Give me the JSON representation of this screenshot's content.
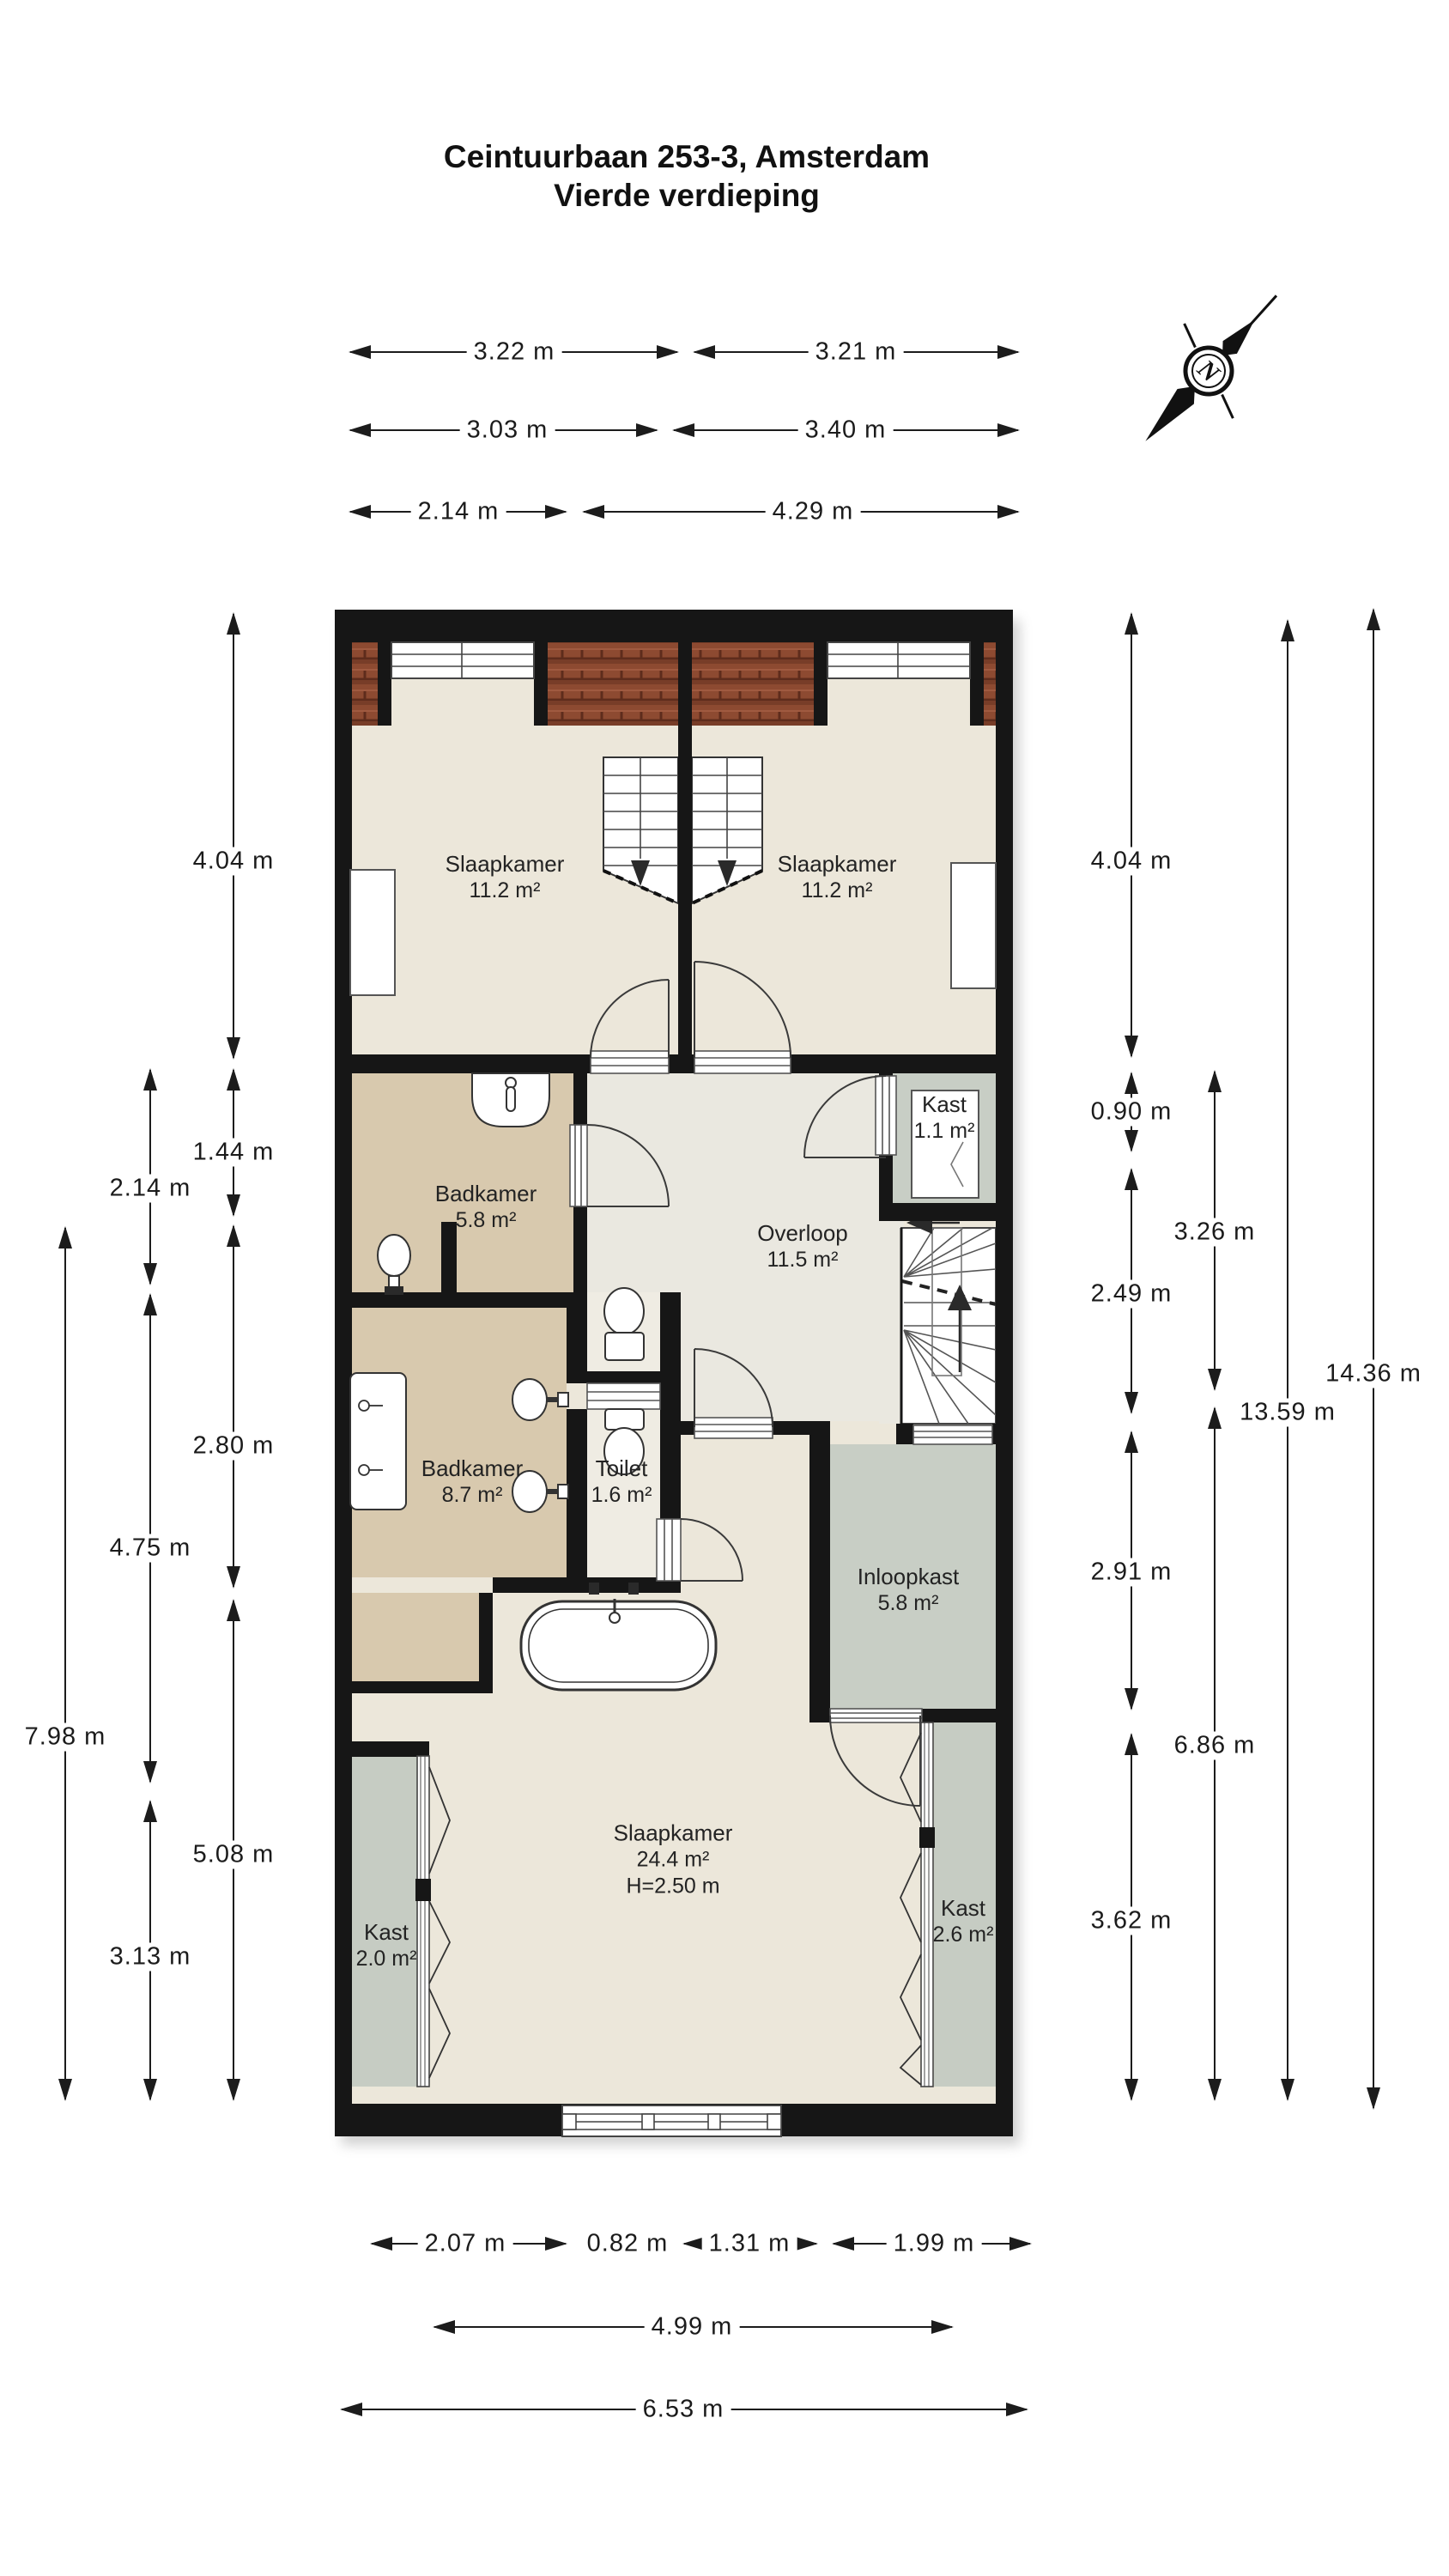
{
  "title": {
    "line1": "Ceintuurbaan 253-3, Amsterdam",
    "line2": "Vierde verdieping"
  },
  "compass": {
    "label": "N"
  },
  "rooms": [
    {
      "name": "Slaapkamer",
      "area": "11.2 m²"
    },
    {
      "name": "Slaapkamer",
      "area": "11.2 m²"
    },
    {
      "name": "Badkamer",
      "area": "5.8 m²"
    },
    {
      "name": "Kast",
      "area": "1.1 m²"
    },
    {
      "name": "Overloop",
      "area": "11.5 m²"
    },
    {
      "name": "Badkamer",
      "area": "8.7 m²"
    },
    {
      "name": "Toilet",
      "area": "1.6 m²"
    },
    {
      "name": "Inloopkast",
      "area": "5.8 m²"
    },
    {
      "name": "Slaapkamer",
      "area": "24.4 m²",
      "height": "H=2.50 m"
    },
    {
      "name": "Kast",
      "area": "2.0 m²"
    },
    {
      "name": "Kast",
      "area": "2.6 m²"
    }
  ],
  "dimensions": {
    "top": [
      "3.22 m",
      "3.21 m",
      "3.03 m",
      "3.40 m",
      "2.14 m",
      "4.29 m"
    ],
    "bottom": [
      "2.07 m",
      "0.82 m",
      "1.31 m",
      "1.99 m",
      "4.99 m",
      "6.53 m"
    ],
    "left": [
      "4.04 m",
      "1.44 m",
      "2.80 m",
      "5.08 m",
      "2.14 m",
      "4.75 m",
      "3.13 m",
      "7.98 m"
    ],
    "right": [
      "4.04 m",
      "0.90 m",
      "2.49 m",
      "2.91 m",
      "3.62 m",
      "3.26 m",
      "6.86 m",
      "13.59 m",
      "14.36 m"
    ]
  },
  "colors": {
    "wall": "#161616",
    "floor_bedroom": "#ece7da",
    "floor_bathroom": "#d8c9ae",
    "floor_landing": "#eae8e0",
    "floor_closet": "#c8cec5",
    "roof_tiles": "#8d4a31",
    "dimension_lines": "#1c1c1c"
  }
}
